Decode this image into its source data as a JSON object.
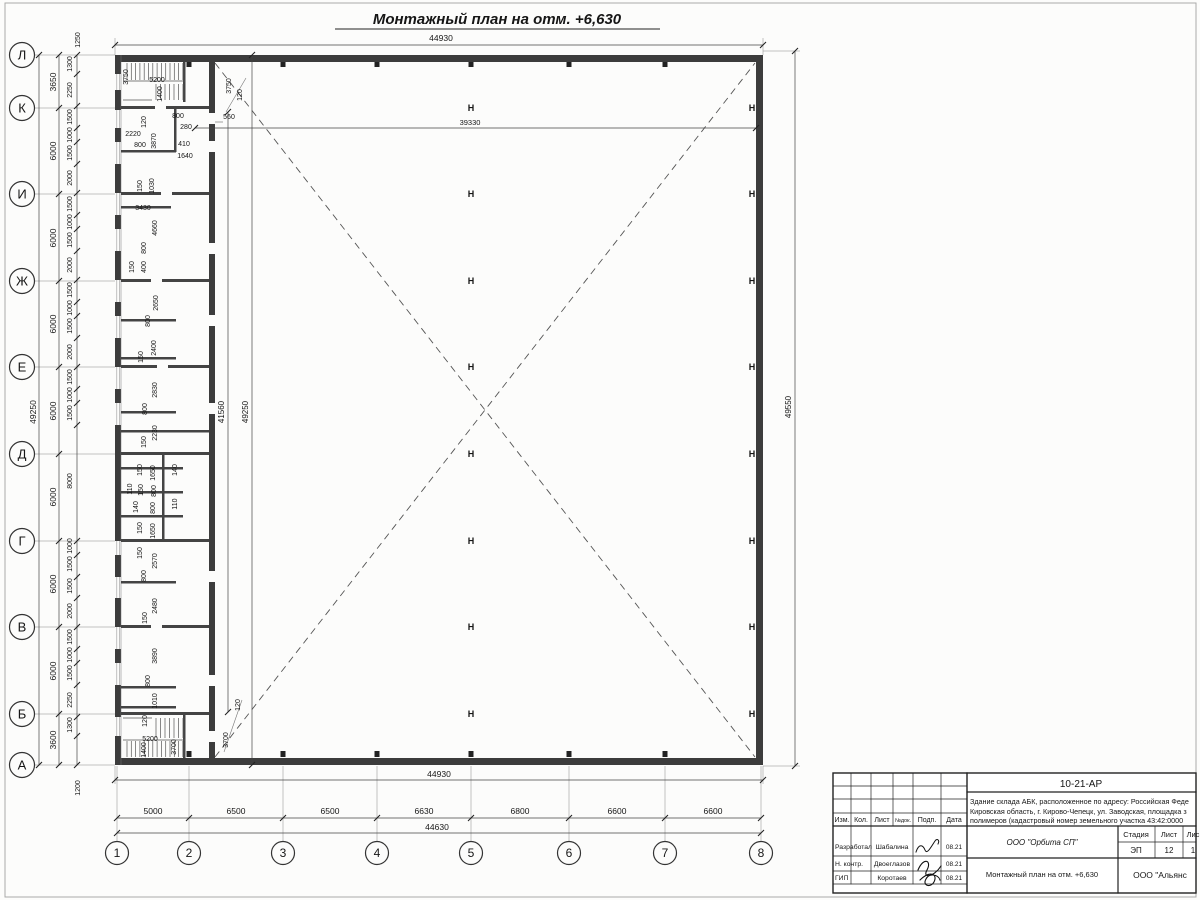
{
  "sheet": {
    "title": "Монтажный план на отм. +6,630"
  },
  "symbols": {
    "column_marker": "Н"
  },
  "axes": {
    "rows": [
      "Л",
      "К",
      "И",
      "Ж",
      "Е",
      "Д",
      "Г",
      "В",
      "Б",
      "А"
    ],
    "cols": [
      "1",
      "2",
      "3",
      "4",
      "5",
      "6",
      "7",
      "8"
    ]
  },
  "title_block": {
    "code": "10-21-АР",
    "description_lines": [
      "Здание склада АБК, расположенное по адресу: Российская Феде",
      "Кировская область, г. Кирово-Чепецк, ул. Заводская, площадка з",
      "полимеров (кадастровый номер земельного участка 43:42:0000"
    ],
    "columns": [
      "Изм.",
      "Кол.",
      "Лист",
      "№док.",
      "Подп.",
      "Дата"
    ],
    "rows": [
      {
        "role": "Разработал",
        "name": "Шабалина",
        "date": "08.21"
      },
      {
        "role": "Н. контр.",
        "name": "Двоеглазов",
        "date": "08.21"
      },
      {
        "role": "ГИП",
        "name": "Коротаев",
        "date": "08.21"
      }
    ],
    "org": "ООО \"Орбита СП\"",
    "doc_title": "Монтажный план на отм. +6,630",
    "org2": "ООО \"Альянс",
    "stage_headers": [
      "Стадия",
      "Лист",
      "Лис"
    ],
    "stage_values": [
      "ЭП",
      "12",
      "1"
    ]
  },
  "annotations": [
    {
      "t": "44930",
      "x": 441,
      "y": 41,
      "s": 8.5
    },
    {
      "t": "44930",
      "x": 439,
      "y": 777,
      "s": 8.5
    },
    {
      "t": "44630",
      "x": 437,
      "y": 830,
      "s": 8.5
    },
    {
      "t": "5000",
      "x": 153,
      "y": 814,
      "s": 8.5
    },
    {
      "t": "6500",
      "x": 236,
      "y": 814,
      "s": 8.5
    },
    {
      "t": "6500",
      "x": 330,
      "y": 814,
      "s": 8.5
    },
    {
      "t": "6630",
      "x": 424,
      "y": 814,
      "s": 8.5
    },
    {
      "t": "6800",
      "x": 520,
      "y": 814,
      "s": 8.5
    },
    {
      "t": "6600",
      "x": 617,
      "y": 814,
      "s": 8.5
    },
    {
      "t": "6600",
      "x": 713,
      "y": 814,
      "s": 8.5
    },
    {
      "t": "49250",
      "x": 36,
      "y": 412,
      "r": 1,
      "s": 8.5
    },
    {
      "t": "3650",
      "x": 56,
      "y": 82,
      "r": 1,
      "s": 8.5
    },
    {
      "t": "6000",
      "x": 56,
      "y": 151,
      "r": 1,
      "s": 8.5
    },
    {
      "t": "6000",
      "x": 56,
      "y": 238,
      "r": 1,
      "s": 8.5
    },
    {
      "t": "6000",
      "x": 56,
      "y": 324,
      "r": 1,
      "s": 8.5
    },
    {
      "t": "6000",
      "x": 56,
      "y": 411,
      "r": 1,
      "s": 8.5
    },
    {
      "t": "6000",
      "x": 56,
      "y": 497,
      "r": 1,
      "s": 8.5
    },
    {
      "t": "6000",
      "x": 56,
      "y": 584,
      "r": 1,
      "s": 8.5
    },
    {
      "t": "6000",
      "x": 56,
      "y": 671,
      "r": 1,
      "s": 8.5
    },
    {
      "t": "3600",
      "x": 56,
      "y": 740,
      "r": 1,
      "s": 8.5
    },
    {
      "t": "1250",
      "x": 80,
      "y": 40,
      "r": 1
    },
    {
      "t": "1300",
      "x": 72,
      "y": 64,
      "r": 1
    },
    {
      "t": "2250",
      "x": 72,
      "y": 90,
      "r": 1
    },
    {
      "t": "1500",
      "x": 72,
      "y": 117,
      "r": 1
    },
    {
      "t": "1000",
      "x": 72,
      "y": 135,
      "r": 1
    },
    {
      "t": "1500",
      "x": 72,
      "y": 153,
      "r": 1
    },
    {
      "t": "2000",
      "x": 72,
      "y": 178,
      "r": 1
    },
    {
      "t": "1500",
      "x": 72,
      "y": 204,
      "r": 1
    },
    {
      "t": "1000",
      "x": 72,
      "y": 222,
      "r": 1
    },
    {
      "t": "1500",
      "x": 72,
      "y": 240,
      "r": 1
    },
    {
      "t": "2000",
      "x": 72,
      "y": 265,
      "r": 1
    },
    {
      "t": "1500",
      "x": 72,
      "y": 290,
      "r": 1
    },
    {
      "t": "1000",
      "x": 72,
      "y": 308,
      "r": 1
    },
    {
      "t": "1500",
      "x": 72,
      "y": 326,
      "r": 1
    },
    {
      "t": "2000",
      "x": 72,
      "y": 352,
      "r": 1
    },
    {
      "t": "1500",
      "x": 72,
      "y": 377,
      "r": 1
    },
    {
      "t": "1000",
      "x": 72,
      "y": 395,
      "r": 1
    },
    {
      "t": "1500",
      "x": 72,
      "y": 413,
      "r": 1
    },
    {
      "t": "8000",
      "x": 72,
      "y": 481,
      "r": 1
    },
    {
      "t": "1000",
      "x": 72,
      "y": 546,
      "r": 1
    },
    {
      "t": "1500",
      "x": 72,
      "y": 564,
      "r": 1
    },
    {
      "t": "1500",
      "x": 72,
      "y": 586,
      "r": 1
    },
    {
      "t": "2000",
      "x": 72,
      "y": 611,
      "r": 1
    },
    {
      "t": "1500",
      "x": 72,
      "y": 637,
      "r": 1
    },
    {
      "t": "1000",
      "x": 72,
      "y": 655,
      "r": 1
    },
    {
      "t": "1500",
      "x": 72,
      "y": 673,
      "r": 1
    },
    {
      "t": "2250",
      "x": 72,
      "y": 700,
      "r": 1
    },
    {
      "t": "1300",
      "x": 72,
      "y": 725,
      "r": 1
    },
    {
      "t": "1200",
      "x": 80,
      "y": 788,
      "r": 1
    },
    {
      "t": "39330",
      "x": 470,
      "y": 125,
      "s": 7.5
    },
    {
      "t": "41560",
      "x": 224,
      "y": 412,
      "r": 1,
      "s": 8
    },
    {
      "t": "49250",
      "x": 248,
      "y": 412,
      "r": 1,
      "s": 8
    },
    {
      "t": "49550",
      "x": 791,
      "y": 407,
      "r": 1,
      "s": 8
    },
    {
      "t": "3750",
      "x": 231,
      "y": 86,
      "r": 1
    },
    {
      "t": "120",
      "x": 242,
      "y": 95,
      "r": 1
    },
    {
      "t": "3700",
      "x": 228,
      "y": 740,
      "r": 1
    },
    {
      "t": "120",
      "x": 240,
      "y": 705,
      "r": 1
    },
    {
      "t": "560",
      "x": 229,
      "y": 119
    },
    {
      "t": "3750",
      "x": 128,
      "y": 77,
      "r": 1
    },
    {
      "t": "5200",
      "x": 157,
      "y": 82
    },
    {
      "t": "1400",
      "x": 162,
      "y": 94,
      "r": 1
    },
    {
      "t": "120",
      "x": 146,
      "y": 122,
      "r": 1
    },
    {
      "t": "800",
      "x": 178,
      "y": 118
    },
    {
      "t": "280",
      "x": 186,
      "y": 129
    },
    {
      "t": "2220",
      "x": 133,
      "y": 136
    },
    {
      "t": "800",
      "x": 140,
      "y": 147
    },
    {
      "t": "3870",
      "x": 156,
      "y": 141,
      "r": 1
    },
    {
      "t": "410",
      "x": 184,
      "y": 146
    },
    {
      "t": "1640",
      "x": 185,
      "y": 158
    },
    {
      "t": "150",
      "x": 142,
      "y": 186,
      "r": 1
    },
    {
      "t": "1030",
      "x": 154,
      "y": 186,
      "r": 1
    },
    {
      "t": "3430",
      "x": 143,
      "y": 210
    },
    {
      "t": "4660",
      "x": 157,
      "y": 228,
      "r": 1
    },
    {
      "t": "800",
      "x": 146,
      "y": 248,
      "r": 1
    },
    {
      "t": "400",
      "x": 146,
      "y": 267,
      "r": 1
    },
    {
      "t": "150",
      "x": 134,
      "y": 267,
      "r": 1
    },
    {
      "t": "2650",
      "x": 158,
      "y": 303,
      "r": 1
    },
    {
      "t": "800",
      "x": 150,
      "y": 321,
      "r": 1
    },
    {
      "t": "2400",
      "x": 156,
      "y": 348,
      "r": 1
    },
    {
      "t": "150",
      "x": 143,
      "y": 357,
      "r": 1
    },
    {
      "t": "2830",
      "x": 157,
      "y": 390,
      "r": 1
    },
    {
      "t": "800",
      "x": 147,
      "y": 409,
      "r": 1
    },
    {
      "t": "2230",
      "x": 157,
      "y": 433,
      "r": 1
    },
    {
      "t": "150",
      "x": 146,
      "y": 442,
      "r": 1
    },
    {
      "t": "150",
      "x": 142,
      "y": 470,
      "r": 1
    },
    {
      "t": "1650",
      "x": 155,
      "y": 473,
      "r": 1
    },
    {
      "t": "140",
      "x": 177,
      "y": 470,
      "r": 1
    },
    {
      "t": "110",
      "x": 132,
      "y": 489,
      "r": 1
    },
    {
      "t": "150",
      "x": 143,
      "y": 490,
      "r": 1
    },
    {
      "t": "800",
      "x": 156,
      "y": 491,
      "r": 1
    },
    {
      "t": "140",
      "x": 138,
      "y": 507,
      "r": 1
    },
    {
      "t": "800",
      "x": 155,
      "y": 508,
      "r": 1
    },
    {
      "t": "110",
      "x": 177,
      "y": 504,
      "r": 1
    },
    {
      "t": "150",
      "x": 142,
      "y": 528,
      "r": 1
    },
    {
      "t": "1650",
      "x": 155,
      "y": 531,
      "r": 1
    },
    {
      "t": "150",
      "x": 142,
      "y": 553,
      "r": 1
    },
    {
      "t": "2570",
      "x": 157,
      "y": 561,
      "r": 1
    },
    {
      "t": "800",
      "x": 146,
      "y": 576,
      "r": 1
    },
    {
      "t": "2480",
      "x": 157,
      "y": 606,
      "r": 1
    },
    {
      "t": "150",
      "x": 147,
      "y": 618,
      "r": 1
    },
    {
      "t": "3890",
      "x": 157,
      "y": 656,
      "r": 1
    },
    {
      "t": "800",
      "x": 150,
      "y": 681,
      "r": 1
    },
    {
      "t": "1010",
      "x": 157,
      "y": 701,
      "r": 1
    },
    {
      "t": "120",
      "x": 147,
      "y": 721,
      "r": 1
    },
    {
      "t": "5200",
      "x": 150,
      "y": 741
    },
    {
      "t": "1400",
      "x": 146,
      "y": 750,
      "r": 1
    },
    {
      "t": "3700",
      "x": 176,
      "y": 747,
      "r": 1
    }
  ]
}
